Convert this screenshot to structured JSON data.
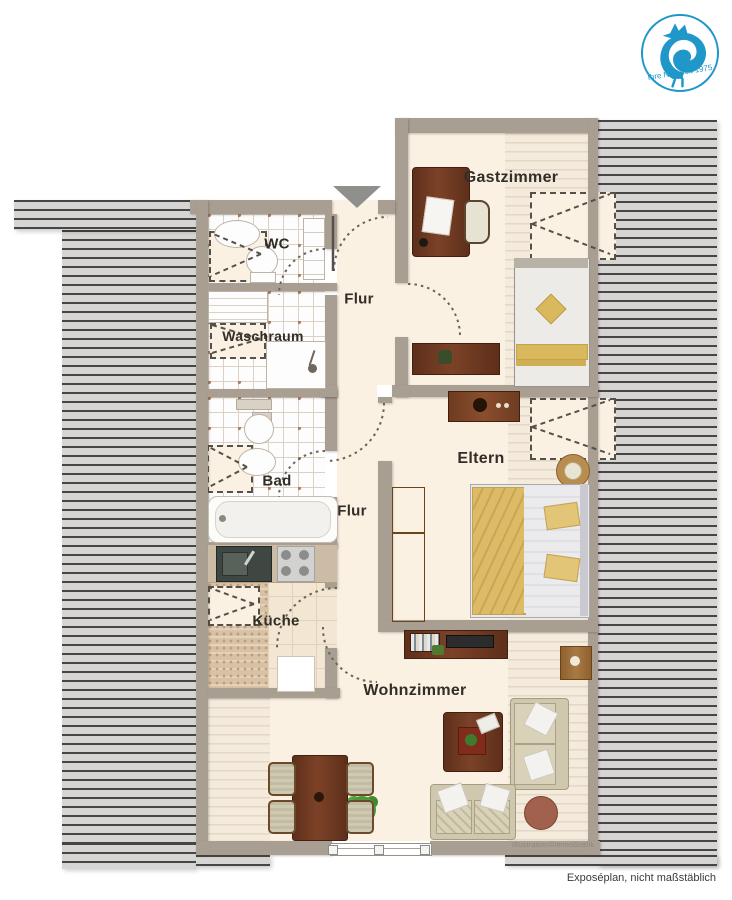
{
  "logo": {
    "slogan": "Ihre Nr.1 seit 1975",
    "color": "#1f97c9"
  },
  "rooms": {
    "gastzimmer": {
      "label": "Gastzimmer"
    },
    "wc": {
      "label": "WC"
    },
    "waschraum": {
      "label": "Waschraum"
    },
    "flur_oben": {
      "label": "Flur"
    },
    "bad": {
      "label": "Bad"
    },
    "flur_unten": {
      "label": "Flur"
    },
    "eltern": {
      "label": "Eltern"
    },
    "kueche": {
      "label": "Küche"
    },
    "wohnzimmer": {
      "label": "Wohnzimmer"
    }
  },
  "annotations": {
    "watermark": "Illustration©ImmoGrafik",
    "disclaimer": "Exposéplan, nicht maßstäblich"
  },
  "legend_colors": {
    "wall": "#a99e92",
    "roof_hatch": "#d6d5d3",
    "floor": "#faf1e3",
    "wood_dark": "#6f3d26",
    "textile_gold": "#d9b85e",
    "logo_blue": "#1f97c9"
  }
}
